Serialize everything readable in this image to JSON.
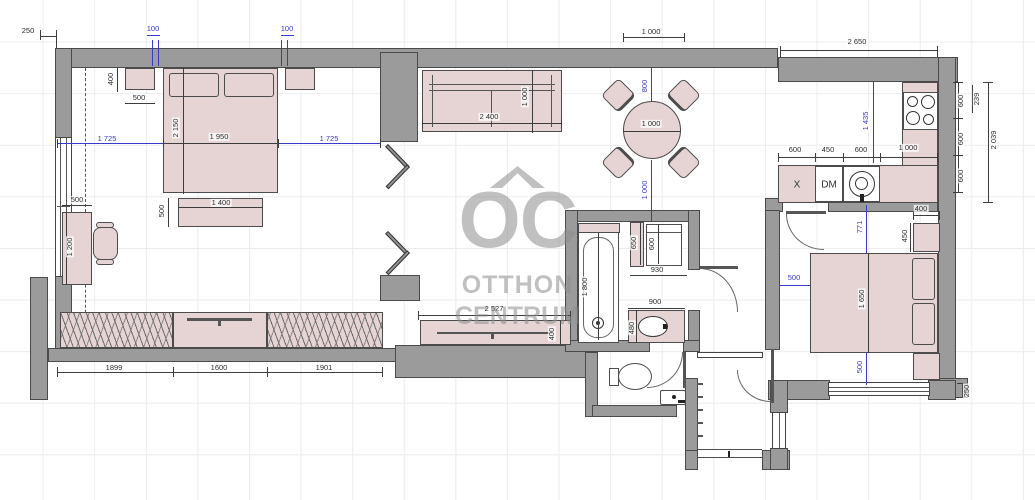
{
  "watermark": {
    "logo": "OC",
    "brand_line1": "OTTHON",
    "brand_line2": "CENTRUM"
  },
  "kitchen": {
    "appliance_label_x": "X",
    "appliance_label_dm": "DM"
  },
  "colors": {
    "wall": "#9b9b9b",
    "furniture": "#e5d4d3",
    "dim_black": "#3d3d3d",
    "dim_blue": "#3a3acc",
    "watermark": "#8c8c8c"
  },
  "dimension_labels": [
    {
      "t": "250",
      "x": 28,
      "y": 31,
      "r": 0,
      "b": 0
    },
    {
      "t": "100",
      "x": 153,
      "y": 29,
      "r": 0,
      "b": 1
    },
    {
      "t": "100",
      "x": 287,
      "y": 29,
      "r": 0,
      "b": 1
    },
    {
      "t": "400",
      "x": 111,
      "y": 79,
      "r": 1,
      "b": 0
    },
    {
      "t": "500",
      "x": 139,
      "y": 98,
      "r": 0,
      "b": 0
    },
    {
      "t": "2 150",
      "x": 176,
      "y": 128,
      "r": 1,
      "b": 0
    },
    {
      "t": "1 950",
      "x": 219,
      "y": 137,
      "r": 0,
      "b": 0
    },
    {
      "t": "1 725",
      "x": 107,
      "y": 139,
      "r": 0,
      "b": 1
    },
    {
      "t": "1 725",
      "x": 329,
      "y": 139,
      "r": 0,
      "b": 1
    },
    {
      "t": "500",
      "x": 162,
      "y": 211,
      "r": 1,
      "b": 0
    },
    {
      "t": "1 400",
      "x": 221,
      "y": 203,
      "r": 0,
      "b": 0
    },
    {
      "t": "500",
      "x": 77,
      "y": 200,
      "r": 0,
      "b": 0
    },
    {
      "t": "1 200",
      "x": 70,
      "y": 247,
      "r": 1,
      "b": 0
    },
    {
      "t": "1899",
      "x": 114,
      "y": 368,
      "r": 0,
      "b": 0
    },
    {
      "t": "1600",
      "x": 219,
      "y": 368,
      "r": 0,
      "b": 0
    },
    {
      "t": "1901",
      "x": 324,
      "y": 368,
      "r": 0,
      "b": 0
    },
    {
      "t": "2 400",
      "x": 489,
      "y": 117,
      "r": 0,
      "b": 0
    },
    {
      "t": "1 000",
      "x": 525,
      "y": 97,
      "r": 1,
      "b": 0
    },
    {
      "t": "1 000",
      "x": 651,
      "y": 32,
      "r": 0,
      "b": 0
    },
    {
      "t": "800",
      "x": 645,
      "y": 86,
      "r": 1,
      "b": 1
    },
    {
      "t": "1 000",
      "x": 651,
      "y": 124,
      "r": 0,
      "b": 0
    },
    {
      "t": "1 000",
      "x": 645,
      "y": 190,
      "r": 1,
      "b": 1
    },
    {
      "t": "2 650",
      "x": 857,
      "y": 42,
      "r": 0,
      "b": 0
    },
    {
      "t": "1 435",
      "x": 866,
      "y": 121,
      "r": 1,
      "b": 1
    },
    {
      "t": "600",
      "x": 795,
      "y": 150,
      "r": 0,
      "b": 0
    },
    {
      "t": "450",
      "x": 828,
      "y": 150,
      "r": 0,
      "b": 0
    },
    {
      "t": "600",
      "x": 861,
      "y": 150,
      "r": 0,
      "b": 0
    },
    {
      "t": "1 000",
      "x": 908,
      "y": 148,
      "r": 0,
      "b": 0
    },
    {
      "t": "600",
      "x": 961,
      "y": 101,
      "r": 1,
      "b": 0
    },
    {
      "t": "600",
      "x": 961,
      "y": 139,
      "r": 1,
      "b": 0
    },
    {
      "t": "600",
      "x": 961,
      "y": 176,
      "r": 1,
      "b": 0
    },
    {
      "t": "239",
      "x": 977,
      "y": 99,
      "r": 1,
      "b": 0
    },
    {
      "t": "2 039",
      "x": 994,
      "y": 140,
      "r": 1,
      "b": 0
    },
    {
      "t": "400",
      "x": 921,
      "y": 209,
      "r": 0,
      "b": 0
    },
    {
      "t": "450",
      "x": 905,
      "y": 236,
      "r": 1,
      "b": 0
    },
    {
      "t": "1 650",
      "x": 862,
      "y": 299,
      "r": 1,
      "b": 0
    },
    {
      "t": "500",
      "x": 794,
      "y": 278,
      "r": 0,
      "b": 1
    },
    {
      "t": "771",
      "x": 860,
      "y": 227,
      "r": 1,
      "b": 1
    },
    {
      "t": "500",
      "x": 860,
      "y": 367,
      "r": 1,
      "b": 1
    },
    {
      "t": "250",
      "x": 967,
      "y": 391,
      "r": 1,
      "b": 0
    },
    {
      "t": "650",
      "x": 634,
      "y": 243,
      "r": 1,
      "b": 0
    },
    {
      "t": "600",
      "x": 652,
      "y": 244,
      "r": 1,
      "b": 0
    },
    {
      "t": "930",
      "x": 657,
      "y": 270,
      "r": 0,
      "b": 0
    },
    {
      "t": "1 800",
      "x": 585,
      "y": 287,
      "r": 1,
      "b": 0
    },
    {
      "t": "900",
      "x": 655,
      "y": 302,
      "r": 0,
      "b": 0
    },
    {
      "t": "480",
      "x": 632,
      "y": 328,
      "r": 1,
      "b": 0
    },
    {
      "t": "2 527",
      "x": 494,
      "y": 309,
      "r": 0,
      "b": 0
    },
    {
      "t": "400",
      "x": 552,
      "y": 334,
      "r": 1,
      "b": 0
    }
  ]
}
